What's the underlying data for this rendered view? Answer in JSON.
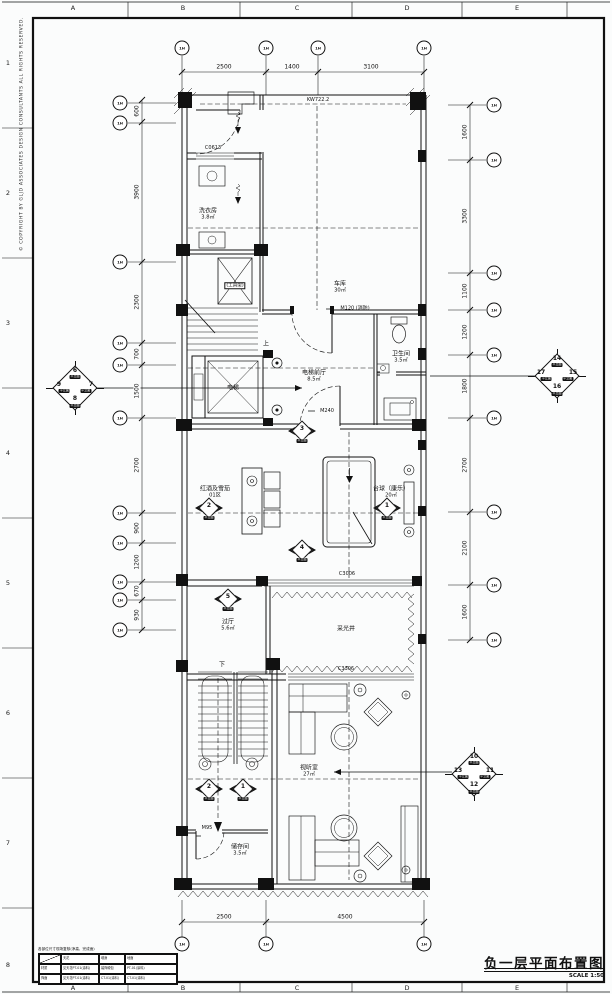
{
  "drawing": {
    "title": "负一层平面布置图",
    "scale_label": "SCALE 1:50",
    "copyright": "© COPYRIGHT BY GLJD ASSOCIATES DESIGN CONSULTANTS ALL RIGHTS RESERVED."
  },
  "grid": {
    "top_letters": [
      "A",
      "B",
      "C",
      "D",
      "E"
    ],
    "bottom_letters": [
      "A",
      "B",
      "C",
      "D",
      "E"
    ],
    "left_numbers": [
      "1",
      "2",
      "3",
      "4",
      "5",
      "6",
      "7",
      "8"
    ],
    "bubble_label": "1H"
  },
  "dimensions": {
    "top": [
      "2500",
      "1400",
      "3100"
    ],
    "bottom": [
      "2500",
      "4500"
    ],
    "left": [
      "600",
      "3900",
      "2300",
      "700",
      "1500",
      "2700",
      "900",
      "1200",
      "670",
      "930"
    ],
    "right": [
      "1600",
      "3300",
      "1100",
      "1200",
      "1800",
      "2700",
      "2100",
      "1600"
    ]
  },
  "rooms": {
    "laundry": {
      "name": "洗衣房",
      "area": "3.8㎡"
    },
    "tool_rack": {
      "name": "(工具架)"
    },
    "garage": {
      "name": "车库",
      "area": "30㎡"
    },
    "stair_up": "上",
    "elevator": {
      "name": "电梯"
    },
    "lobby": {
      "name": "电梯前厅",
      "area": "8.5㎡"
    },
    "bath": {
      "name": "卫生间",
      "area": "3.5㎡"
    },
    "wine": {
      "name": "红酒及雪茄",
      "zone": "01区"
    },
    "billiard": {
      "name": "台球（康乐）",
      "area": "20㎡"
    },
    "hall": {
      "name": "过厅",
      "area": "5.6㎡"
    },
    "lightwell": {
      "name": "采光井"
    },
    "stair_down": "下",
    "av_room": {
      "name": "视听室",
      "area": "27㎡"
    },
    "storage": {
      "name": "储存间",
      "area": "3.5㎡"
    }
  },
  "openings": {
    "level_note": "KW722.2",
    "window_top": "C0613",
    "door_fire": "M120 (消防)",
    "door_m240": "M240",
    "window_billiard": "C3006",
    "window_av": "C3306",
    "door_storage": "M95"
  },
  "markers": {
    "caption": "平立面",
    "left_diamond": {
      "top": "6",
      "left": "9",
      "right": "7",
      "bottom": "8"
    },
    "right_diamond": {
      "top": "14",
      "left": "17",
      "right": "15",
      "bottom": "16"
    },
    "br_diamond": {
      "top": "10",
      "left": "13",
      "right": "11",
      "bottom": "12"
    },
    "dir": [
      {
        "n": "3"
      },
      {
        "n": "2"
      },
      {
        "n": "1"
      },
      {
        "n": "4"
      },
      {
        "n": "5"
      },
      {
        "n": "2"
      },
      {
        "n": "1"
      }
    ]
  },
  "title_block": {
    "note": "各部位尺寸现场复核(净高、完成面)",
    "table": {
      "headers": [
        "",
        "天花",
        "墙身",
        "地面"
      ],
      "rows": [
        [
          "材质",
          "见天花PT-01(涂料)",
          "装饰硬包",
          "PT-01(涂料)"
        ],
        [
          "饰面",
          "见天花PT-01(涂料)",
          "CT-01(涂料)",
          "CT-01(涂料)"
        ]
      ]
    }
  }
}
